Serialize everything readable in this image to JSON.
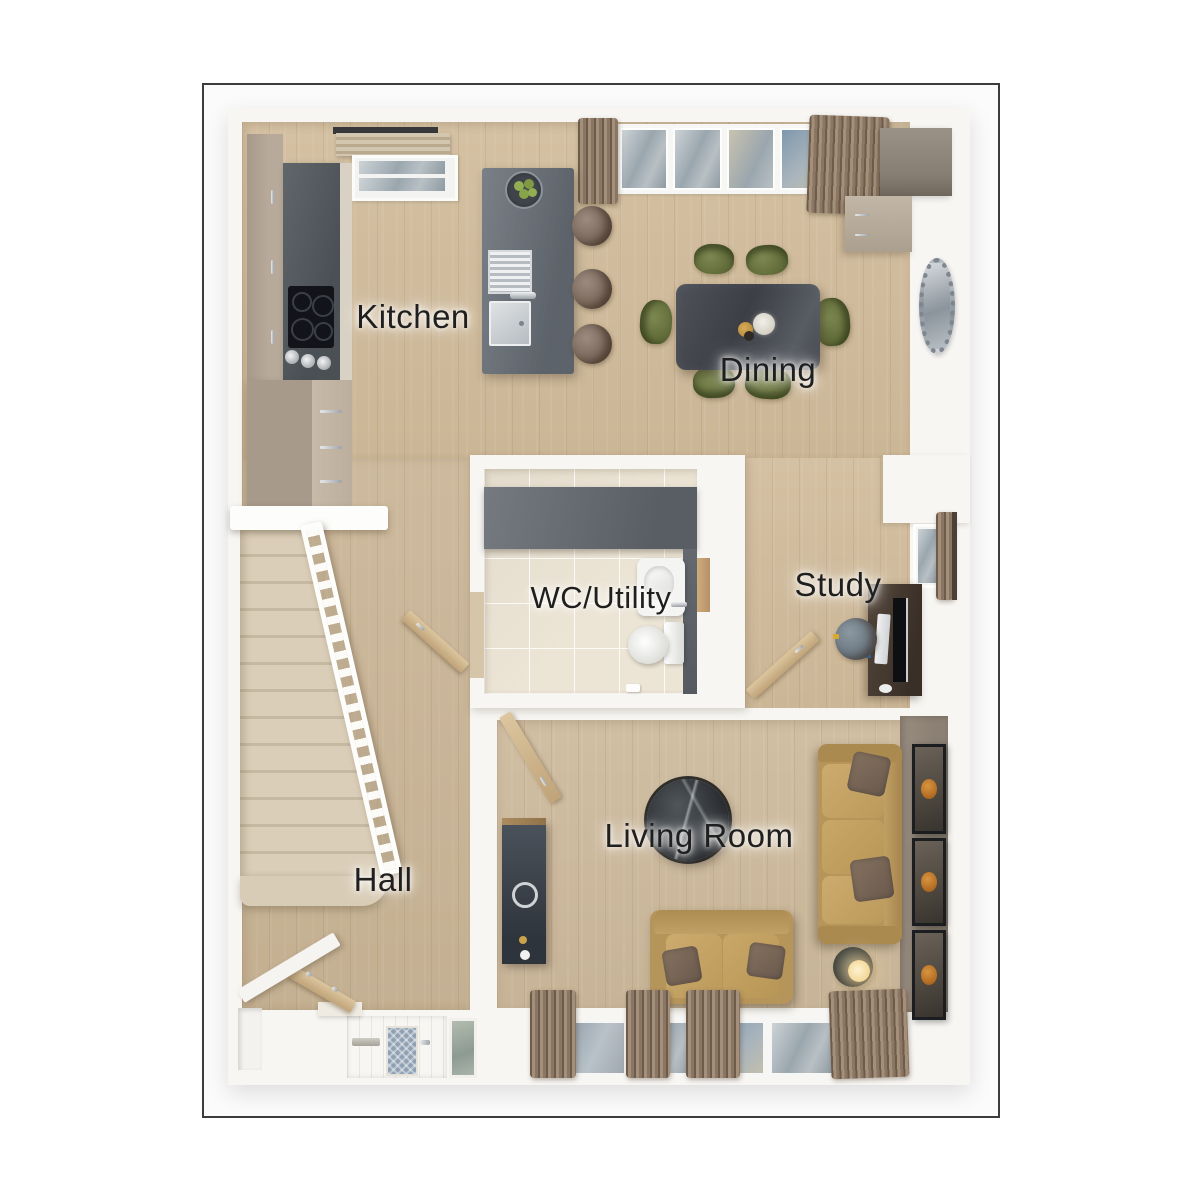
{
  "rooms": {
    "kitchen": {
      "label": "Kitchen"
    },
    "dining": {
      "label": "Dining"
    },
    "wc": {
      "label": "WC/Utility"
    },
    "study": {
      "label": "Study"
    },
    "hall": {
      "label": "Hall"
    },
    "living": {
      "label": "Living Room"
    }
  },
  "palette": {
    "frame_border": "#3c3c3c",
    "wall_white": "#f7f6f3",
    "floor_wood": "#d2bd9d",
    "tile_cream": "#ece4d4",
    "counter_gray": "#5d6267",
    "island_gray": "#6d737a",
    "chair_olive": "#6f7a45",
    "dining_table_dark": "#45484f",
    "sofa_tan": "#c1a065",
    "cushion_brown": "#786659",
    "accent_wall": "#92867a",
    "stairs_carpet": "#d9ccb6",
    "curtain_taupe": "#8a7663",
    "lamp_glow": "#f8e3ae",
    "art_orange": "#c0762c"
  }
}
